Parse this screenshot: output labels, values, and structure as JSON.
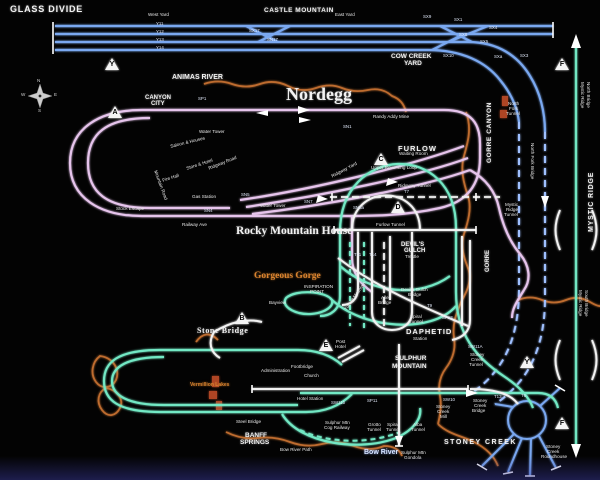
{
  "regions": {
    "glass_divide": "GLASS DIVIDE",
    "castle_mountain": "CASTLE MOUNTAIN",
    "west_yard": "West Yard",
    "east_yard": "East Yard",
    "cow_creek": "COW CREEK",
    "yard": "YARD",
    "animas_river": "ANIMAS RIVER",
    "canyon": "CANYON",
    "city": "CITY",
    "nordegg": "Nordegg",
    "furlow": "FURLOW",
    "gorre_canyon": "GORRE CANYON",
    "mystic_ridge": "MYSTIC RIDGE",
    "rocky_mountain_house": "Rocky Mountain House",
    "devils": "DEVIL'S",
    "gulch": "GULCH",
    "gorgeous_gorge": "Gorgeous Gorge",
    "daphetid": "DAPHETID",
    "sulphur": "SULPHUR",
    "mountain": "MOUNTAIN",
    "gorre": "GORRE",
    "stone_bridge": "Stone Bridge",
    "banff": "BANFF",
    "springs": "SPRINGS",
    "bow_river": "Bow River",
    "stoney_creek": "STONEY CREEK",
    "vermillion_lakes": "Vermillion Lakes"
  },
  "features": [
    "Water Tower",
    "Saloon & Houses",
    "Store & Hotel",
    "Fire Hall",
    "Ridgway Road",
    "Mountain Road",
    "Gas Station",
    "Railway Ave",
    "Stock Escape",
    "Water Tower",
    "Randy Addy Mine",
    "Waiting Room",
    "Upper Reversing Loop",
    "Ridgway Tunnel",
    "Furlow Tunnel",
    "Ridgway Yard",
    "Devil's Gulch",
    "Bridge",
    "Trestle",
    "Spiral",
    "Tunnel",
    "Allen",
    "Bridge",
    "Tunnel Mountain",
    "INSPIRATION",
    "POINT",
    "Post",
    "Hotel",
    "Footbridge",
    "Church",
    "Administration",
    "Bayview",
    "Hotel Station",
    "Sulphur Mtn",
    "Cog Railway",
    "Grotto",
    "Tunnel",
    "Spiral",
    "Tunnel",
    "Alba",
    "Tunnel",
    "Sulphur Mtn",
    "Gondola",
    "Steel Bridge",
    "Bow River Path",
    "North",
    "Fork",
    "Tunnel",
    "North Fork Bridge",
    "Mystic",
    "Ridge",
    "Tunnel",
    "Mystic Ridge",
    "North Bridge",
    "Mystic Ridge",
    "South Bridge",
    "Stoney",
    "Creek",
    "Tunnel",
    "Stoney",
    "Creek",
    "Bridge",
    "Stoney",
    "Creek",
    "Mill",
    "Stoney",
    "Creek",
    "Roundhouse",
    "Station"
  ],
  "switches": [
    "Y11",
    "Y12",
    "Y13",
    "Y14",
    "SX17",
    "SN17",
    "SX9",
    "SX1",
    "SX4",
    "SX8",
    "SX5",
    "SX10",
    "SXa",
    "SX3",
    "SP1",
    "SN1",
    "SN5",
    "SN7",
    "SN6a",
    "SN4",
    "T7",
    "T9",
    "T11",
    "T14",
    "SP13",
    "SW11A",
    "SW11b",
    "SP11",
    "SW10",
    "T13",
    "T6"
  ],
  "markers": [
    "Y",
    "A",
    "C",
    "D",
    "B",
    "E",
    "F",
    "F",
    "Y"
  ],
  "compass": {
    "n": "N",
    "e": "E",
    "s": "S",
    "w": "W"
  },
  "colors": {
    "track_blue": "#7aa8f0",
    "track_pink": "#e6c4ec",
    "track_teal": "#72e8c4",
    "track_white": "#f2f2f2",
    "river_orange": "#c97231",
    "background": "#030303"
  }
}
